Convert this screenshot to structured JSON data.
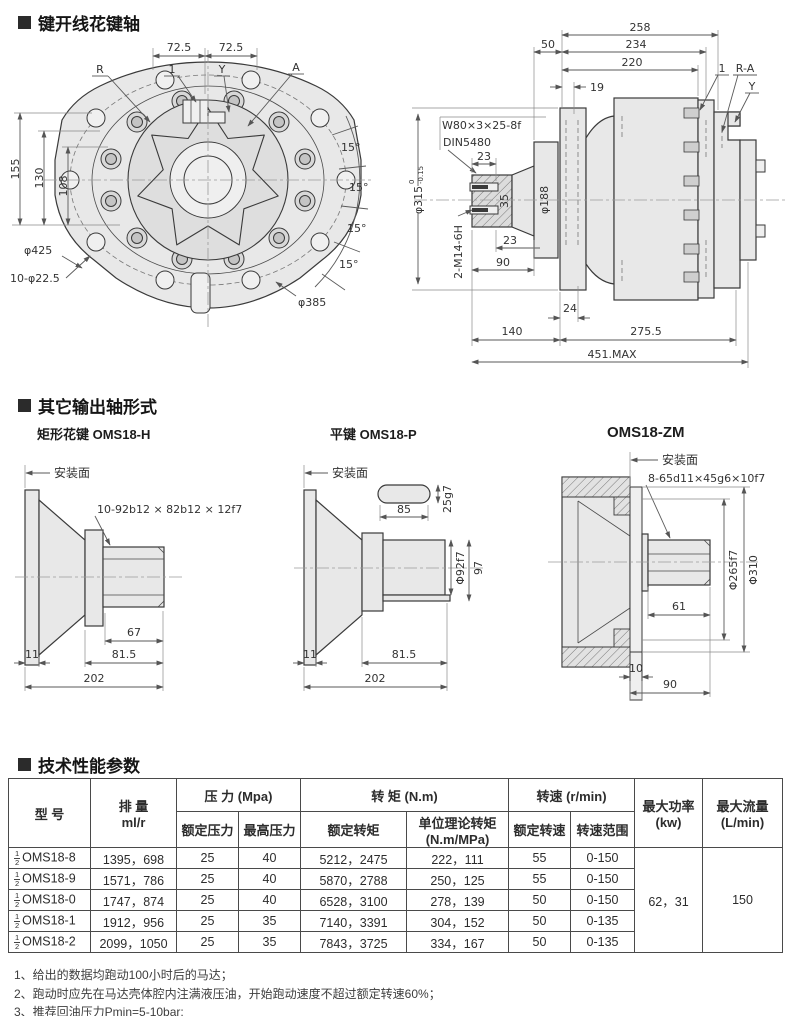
{
  "colors": {
    "ink": "#3a3a3a",
    "dim_line": "#5a5a5a",
    "part_fill": "#e8e8e8",
    "text": "#2f2f2f"
  },
  "sections": {
    "spline": {
      "title": "键开线花键轴"
    },
    "shafts": {
      "title": "其它输出轴形式"
    },
    "specs": {
      "title": "技术性能参数"
    }
  },
  "front_view": {
    "dim_72a": "72.5",
    "dim_72b": "72.5",
    "label_r": "R",
    "label_1": "1",
    "label_y": "Y",
    "label_a": "A",
    "dim_155": "155",
    "dim_130": "130",
    "dim_108": "108",
    "angle_1": "15°",
    "angle_2": "15°",
    "angle_3": "15°",
    "angle_4": "15°",
    "dim_425": "φ425",
    "dim_holes": "10-φ22.5",
    "dim_385": "φ385"
  },
  "side_view": {
    "dim_258": "258",
    "dim_234": "234",
    "dim_220": "220",
    "dim_50": "50",
    "dim_19": "19",
    "label_1": "1",
    "label_ra": "R-A",
    "label_y": "Y",
    "spline_spec": "W80×3×25-8f",
    "din": "DIN5480",
    "dim_23a": "23",
    "dim_188": "φ188",
    "dim_315": "φ315",
    "tol_hi": "0",
    "tol_lo": "-0.15",
    "dim_35": "35",
    "dim_23b": "23",
    "dim_90": "90",
    "thread": "2-M14-6H",
    "dim_24": "24",
    "dim_140": "140",
    "dim_275": "275.5",
    "dim_max": "451.MAX"
  },
  "shaft_h": {
    "title": "矩形花键 OMS18-H",
    "mount": "安装面",
    "spline_spec": "10-92b12 × 82b12 × 12f7",
    "dim_67": "67",
    "dim_11": "11",
    "dim_815": "81.5",
    "dim_202": "202"
  },
  "shaft_p": {
    "title": "平键 OMS18-P",
    "mount": "安装面",
    "dim_85": "85",
    "dim_25": "25g7",
    "dim_92": "Φ92f7",
    "dim_97": "97",
    "dim_11": "11",
    "dim_815": "81.5",
    "dim_202": "202"
  },
  "shaft_zm": {
    "title": "OMS18-ZM",
    "mount": "安装面",
    "spline_spec": "8-65d11×45g6×10f7",
    "dim_265": "Φ265f7",
    "dim_310": "Φ310",
    "dim_61": "61",
    "dim_10": "10",
    "dim_90": "90"
  },
  "table": {
    "col_model": "型  号",
    "col_disp_1": "排 量",
    "col_disp_2": "ml/r",
    "grp_pressure": "压 力 (Mpa)",
    "col_rated_p": "额定压力",
    "col_max_p": "最高压力",
    "grp_torque": "转 矩 (N.m)",
    "col_rated_t": "额定转矩",
    "col_unit_t_1": "单位理论转矩",
    "col_unit_t_2": "(N.m/MPa)",
    "grp_speed": "转速 (r/min)",
    "col_rated_s": "额定转速",
    "col_range_s": "转速范围",
    "col_power_1": "最大功率",
    "col_power_2": "(kw)",
    "col_flow_1": "最大流量",
    "col_flow_2": "(L/min)",
    "rows": [
      {
        "frac_num": "1",
        "frac_den": "2",
        "model": "OMS18-8",
        "displacement": "1395，698",
        "rated_p": "25",
        "max_p": "40",
        "rated_t": "5212，2475",
        "unit_t": "222，111",
        "rated_s": "55",
        "range_s": "0-150"
      },
      {
        "frac_num": "1",
        "frac_den": "2",
        "model": "OMS18-9",
        "displacement": "1571，786",
        "rated_p": "25",
        "max_p": "40",
        "rated_t": "5870，2788",
        "unit_t": "250，125",
        "rated_s": "55",
        "range_s": "0-150"
      },
      {
        "frac_num": "1",
        "frac_den": "2",
        "model": "OMS18-0",
        "displacement": "1747，874",
        "rated_p": "25",
        "max_p": "40",
        "rated_t": "6528，3100",
        "unit_t": "278，139",
        "rated_s": "50",
        "range_s": "0-150"
      },
      {
        "frac_num": "1",
        "frac_den": "2",
        "model": "OMS18-1",
        "displacement": "1912，956",
        "rated_p": "25",
        "max_p": "35",
        "rated_t": "7140，3391",
        "unit_t": "304，152",
        "rated_s": "50",
        "range_s": "0-135"
      },
      {
        "frac_num": "1",
        "frac_den": "2",
        "model": "OMS18-2",
        "displacement": "2099，1050",
        "rated_p": "25",
        "max_p": "35",
        "rated_t": "7843，3725",
        "unit_t": "334，167",
        "rated_s": "50",
        "range_s": "0-135"
      }
    ],
    "max_power": "62，31",
    "max_flow": "150"
  },
  "notes": [
    "1、给出的数据均跑动100小时后的马达；",
    "2、跑动时应先在马达壳体腔内注满液压油，开始跑动速度不超过额定转速60%；",
    "3、推荐回油压力Pmin=5-10bar;"
  ]
}
